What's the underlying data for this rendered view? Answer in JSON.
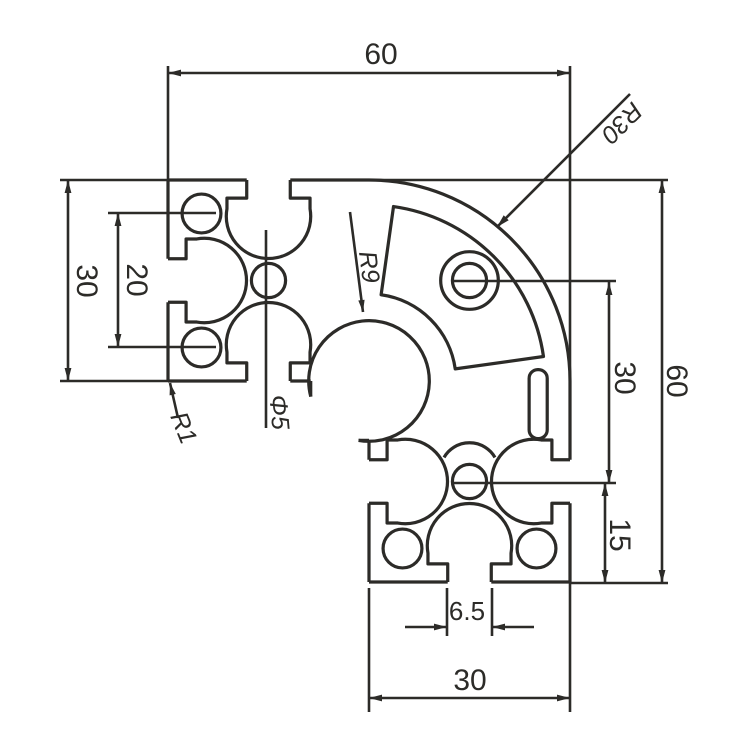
{
  "page": {
    "background": "#ffffff",
    "ink": "#2c2b28",
    "description": "Technical cross-section drawing of a 30x60 quarter-round aluminum extrusion profile"
  },
  "dimensions": {
    "overall_width_top": "60",
    "overall_height_right": "60",
    "hole_span_right": "30",
    "hole_to_bottom_right": "15",
    "leg_height_left": "30",
    "hole_span_left": "20",
    "slot_mouth_width": "6.5",
    "leg_width_bottom": "30"
  },
  "callouts": {
    "outer_corner_radius": "R30",
    "core_arc_radius": "R9",
    "corner_fillet_radius": "R1",
    "center_hole_diameter": "Φ5"
  }
}
